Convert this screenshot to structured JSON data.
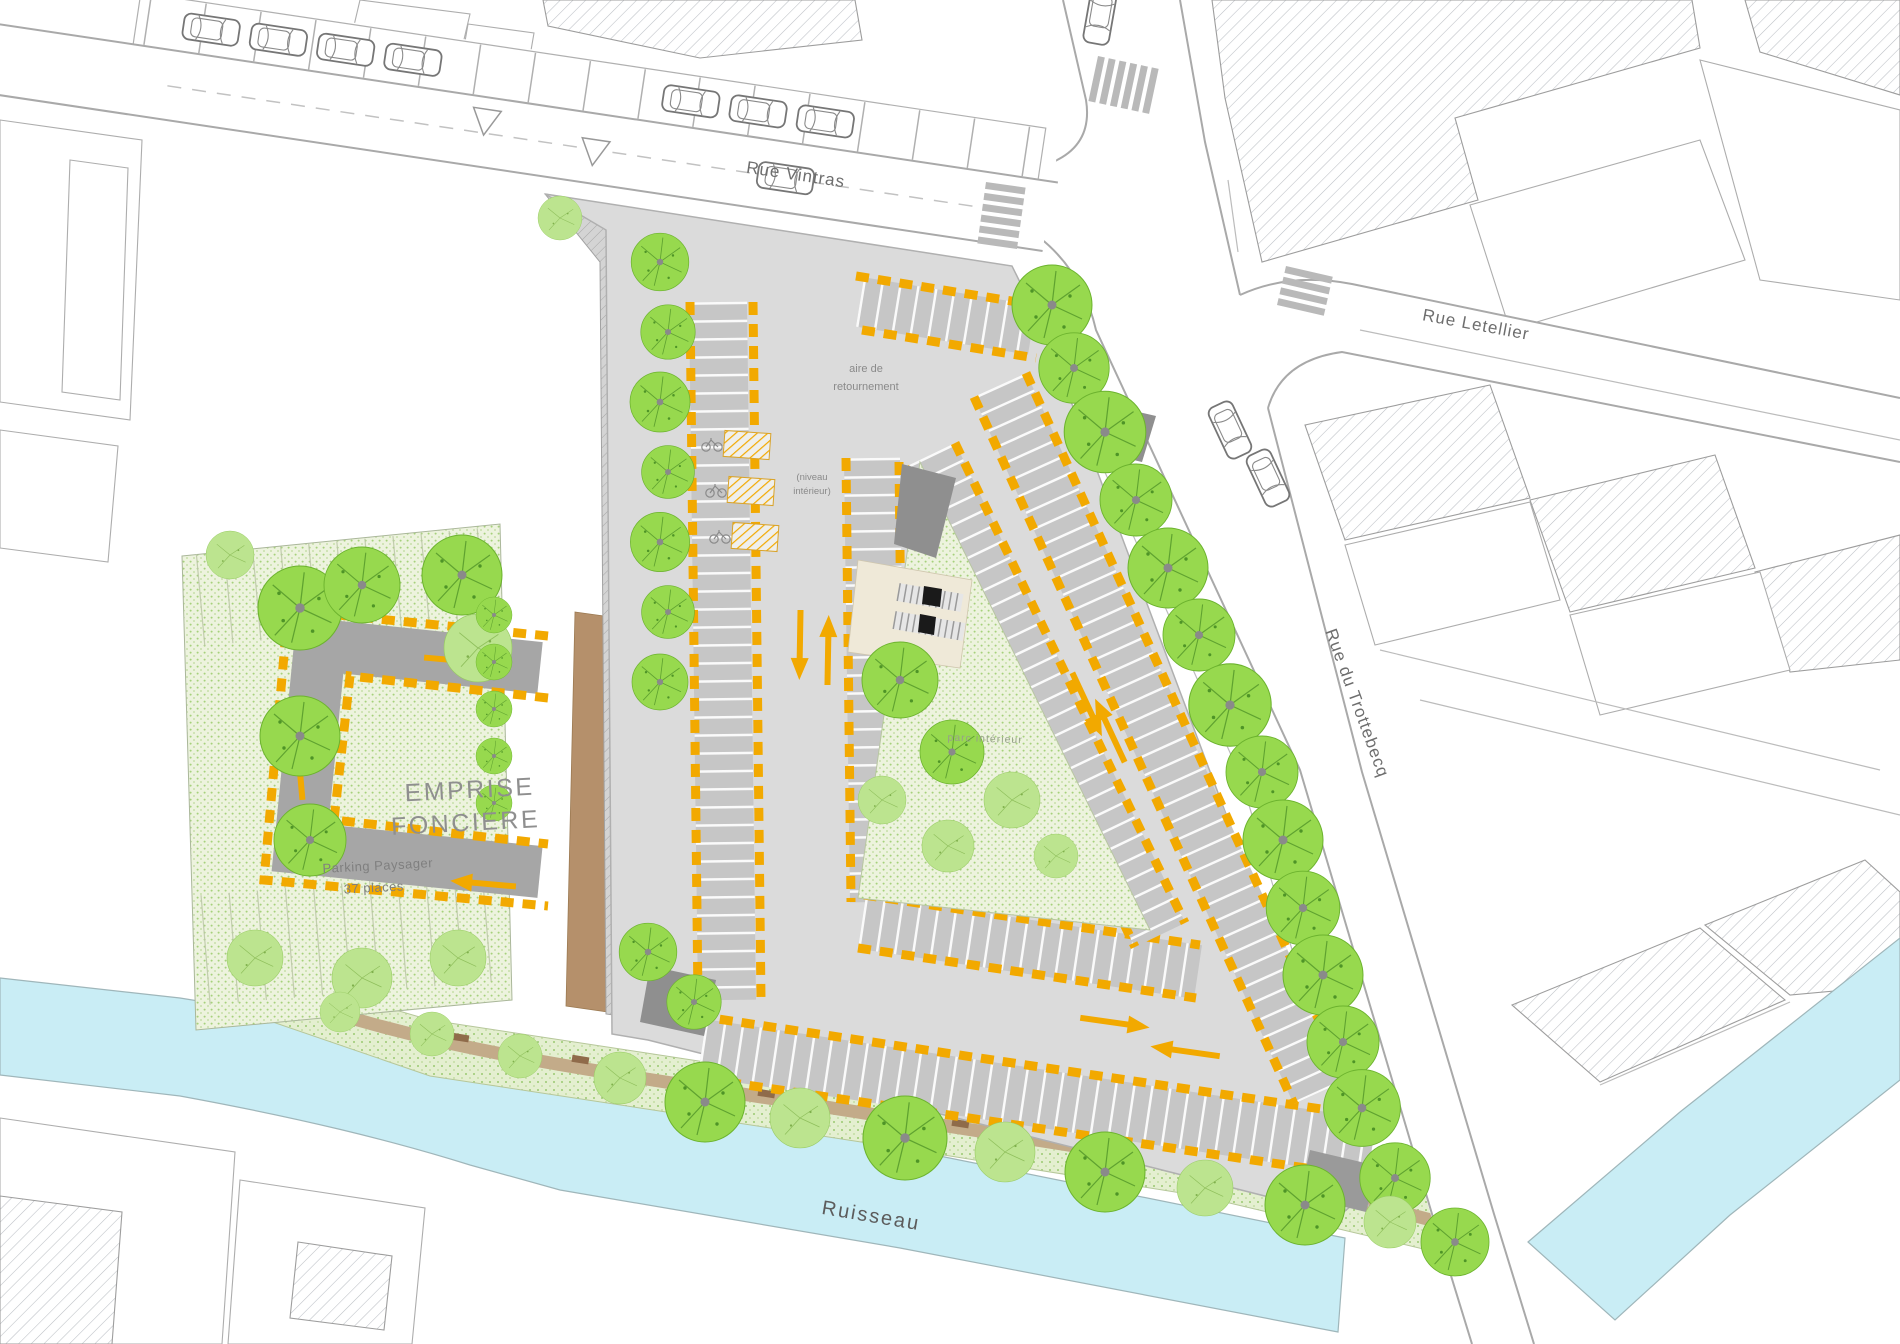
{
  "plan": {
    "streets": {
      "vintras": "Rue Vintras",
      "letellier": "Rue Letellier",
      "trottebecq": "Rue du Trottebecq"
    },
    "water": {
      "ruisseau": "Ruisseau"
    },
    "site": {
      "emprise_l1": "EMPRISE",
      "emprise_l2": "FONCIERE",
      "parking_l1": "Parking Paysager",
      "parking_l2": "37 places",
      "turnaround_l1": "aire de",
      "turnaround_l2": "retournement",
      "interior_note_l1": "(niveau",
      "interior_note_l2": "intérieur)",
      "park": "parc intérieur"
    },
    "colors": {
      "stripe_yellow": "#F2A900",
      "arrow_orange": "#F2A900",
      "tree_green": "#97D94E",
      "tree_light_green": "#BCE48F",
      "water_cyan": "#C9EDF5",
      "pavement_gray": "#DBDBDB",
      "stall_gray": "#C6C6C6",
      "ramp_dark_gray": "#8F8F8F",
      "path_brown": "#B5906B"
    }
  }
}
